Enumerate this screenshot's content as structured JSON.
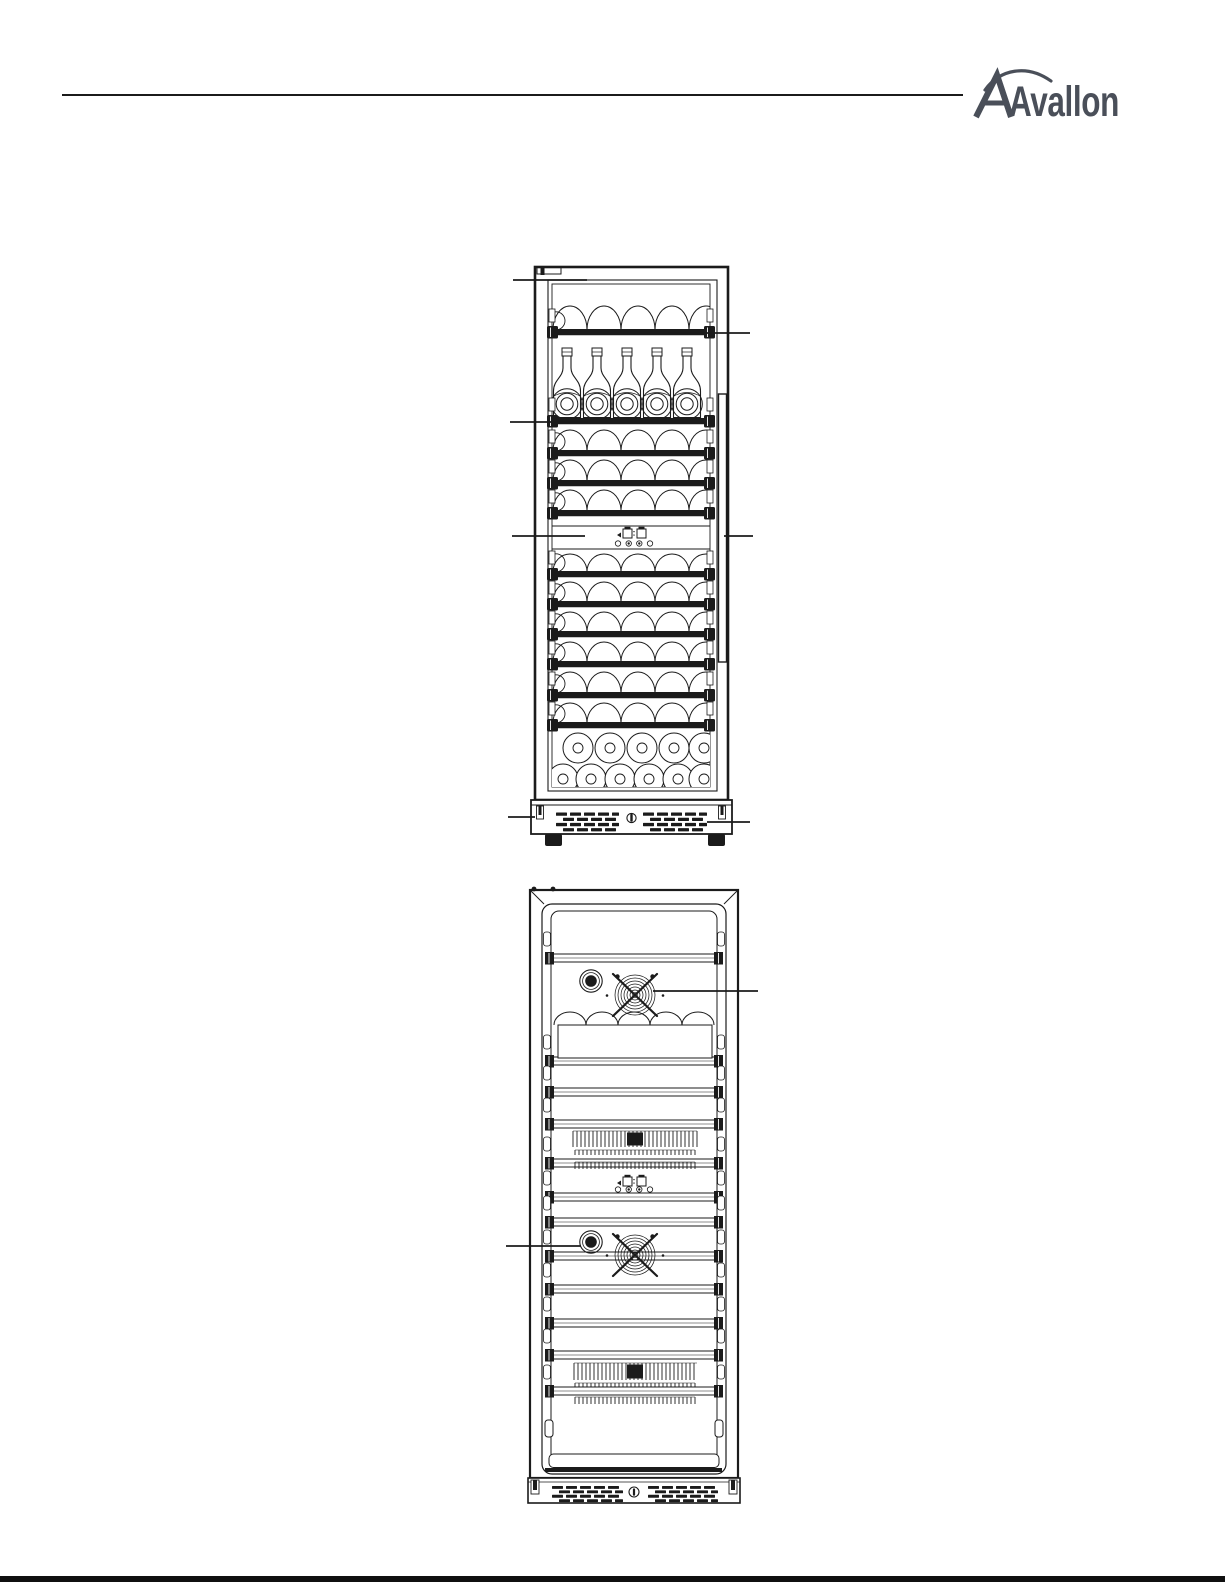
{
  "page": {
    "background": "#ffffff",
    "ink": "#1b1b1b"
  },
  "header": {
    "logo_text": "Avallon",
    "logo_color": "#4a4f59",
    "rule_color": "#1b1b1b"
  },
  "footer": {
    "rule_color": "#101010"
  },
  "figures": {
    "front_view": {
      "callouts": 7
    },
    "interior_view": {
      "callouts": 2
    }
  },
  "icons": {
    "fan": "circulation-fan-icon",
    "light": "interior-light-icon",
    "lock": "door-lock-icon",
    "vent": "vent-grille-icon"
  }
}
